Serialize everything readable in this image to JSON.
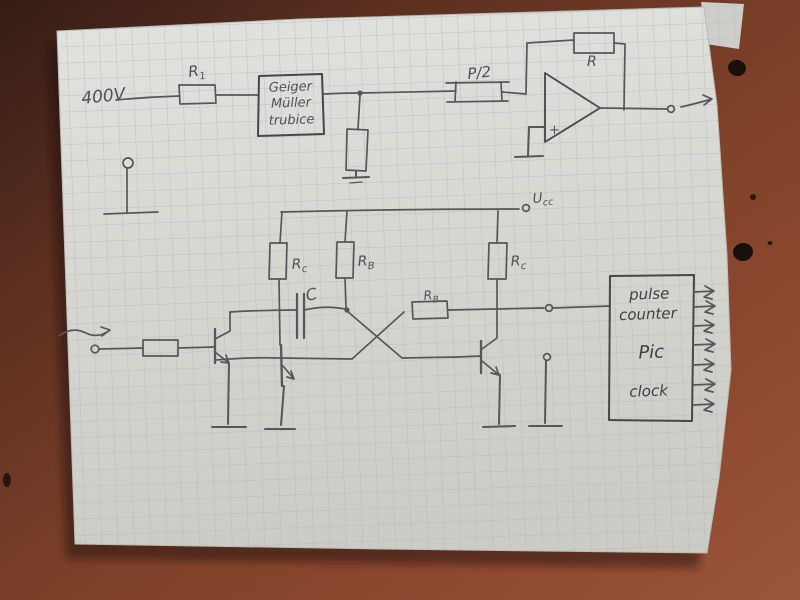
{
  "scene": {
    "description": "Photograph of a hand-drawn Geiger-Muller counter schematic in pencil on squared paper lying on a brown table",
    "colors": {
      "table_brown": "#8b4a31",
      "table_dark": "#3a1f17",
      "paper": "#d9dad5",
      "grid_line": "#b3b8c0",
      "pencil": "#55555c"
    }
  },
  "top_circuit": {
    "supply_label": "400V",
    "r1": {
      "main": "R",
      "sub": "1"
    },
    "geiger_box": {
      "line1": "Geiger",
      "line2": "Müller",
      "line3": "trubice"
    },
    "pot_label": "P/2",
    "feedback_resistor_label": "R",
    "opamp_plus_label": "+"
  },
  "lower_circuit": {
    "supply": {
      "main": "U",
      "sub": "cc"
    },
    "rc_left": {
      "main": "R",
      "sub": "c"
    },
    "rb_left": {
      "main": "R",
      "sub": "B"
    },
    "rc_right": {
      "main": "R",
      "sub": "c"
    },
    "rb_cross": {
      "main": "R",
      "sub": "B"
    },
    "cap_label": "C"
  },
  "counter_box": {
    "line1": "pulse",
    "line2": "counter",
    "line3": "Pic",
    "line4": "clock"
  }
}
